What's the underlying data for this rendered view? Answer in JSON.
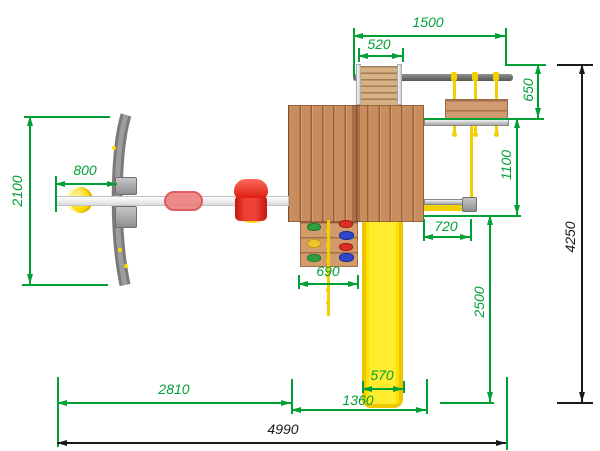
{
  "drawing": {
    "type": "playground-set plan view (top-down technical drawing)",
    "units": "mm"
  },
  "dims": {
    "d1500": "1500",
    "d520": "520",
    "d650": "650",
    "d1100": "1100",
    "d720": "720",
    "d2500": "2500",
    "d690": "690",
    "d570": "570",
    "d800": "800",
    "d2100": "2100",
    "d2810": "2810",
    "d1360": "1360",
    "d4990": "4990",
    "d4250": "4250"
  },
  "colors": {
    "dimension_green": "#00a036",
    "dimension_black": "#1a1a1a",
    "wood": "#c98c5c",
    "wood_light": "#d7b186",
    "slide_yellow": "#ffe71e",
    "rope_yellow": "#f2cf00",
    "beam_gray": "#6e6e6e",
    "rail_gray": "#cfcfcf",
    "seat_red": "#e0241a",
    "trapeze_pink": "#ef8484",
    "ball_yellow": "#ffd900"
  },
  "parts": [
    "swing-frame-leg",
    "swing-arm-beam",
    "ball-swing",
    "trapeze-swing",
    "toddler-swing-seat",
    "tower-roof-platform",
    "entry-ladder",
    "swing-crossbeam",
    "nest-swing-bench",
    "swing-ropes",
    "climbing-wall",
    "climbing-holds",
    "knotted-rope",
    "slide",
    "side-rail-upper",
    "side-rail-lower",
    "hanging-rope"
  ]
}
